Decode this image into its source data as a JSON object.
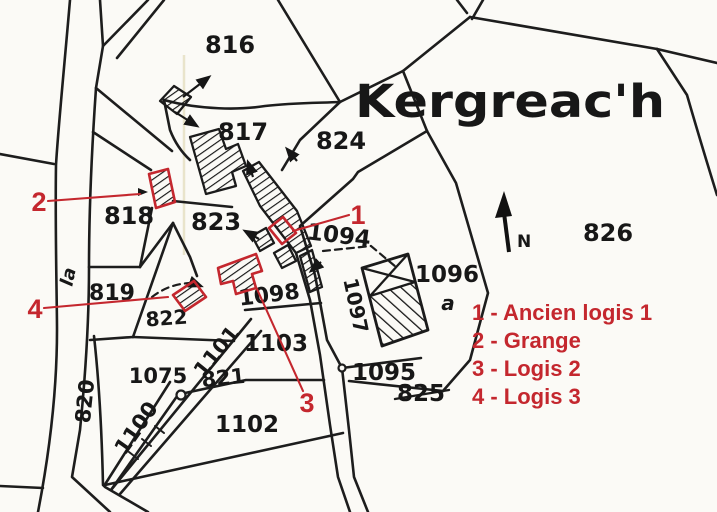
{
  "map": {
    "place_name": "Kergreac'h",
    "north_label": "N",
    "parcels": {
      "p816": "816",
      "p817": "817",
      "p818": "818",
      "p819": "819",
      "p820": "820",
      "p821": "821",
      "p822": "822",
      "p823": "823",
      "p824": "824",
      "p825": "825",
      "p826": "826",
      "p1075": "1075",
      "p1094": "1094",
      "p1095": "1095",
      "p1096": "1096",
      "p1097": "1097",
      "p1098": "1098",
      "p1100": "1100",
      "p1101": "1101",
      "p1102": "1102",
      "p1103": "1103"
    },
    "sub_labels": {
      "road_label": "la",
      "parcel_sub": "a"
    }
  },
  "annotations": {
    "accent_color": "#c4272e",
    "markers": {
      "m1": "1",
      "m2": "2",
      "m3": "3",
      "m4": "4"
    },
    "legend": {
      "items": [
        "1 - Ancien logis 1",
        "2 - Grange",
        "3 - Logis 2",
        "4 - Logis 3"
      ]
    }
  }
}
